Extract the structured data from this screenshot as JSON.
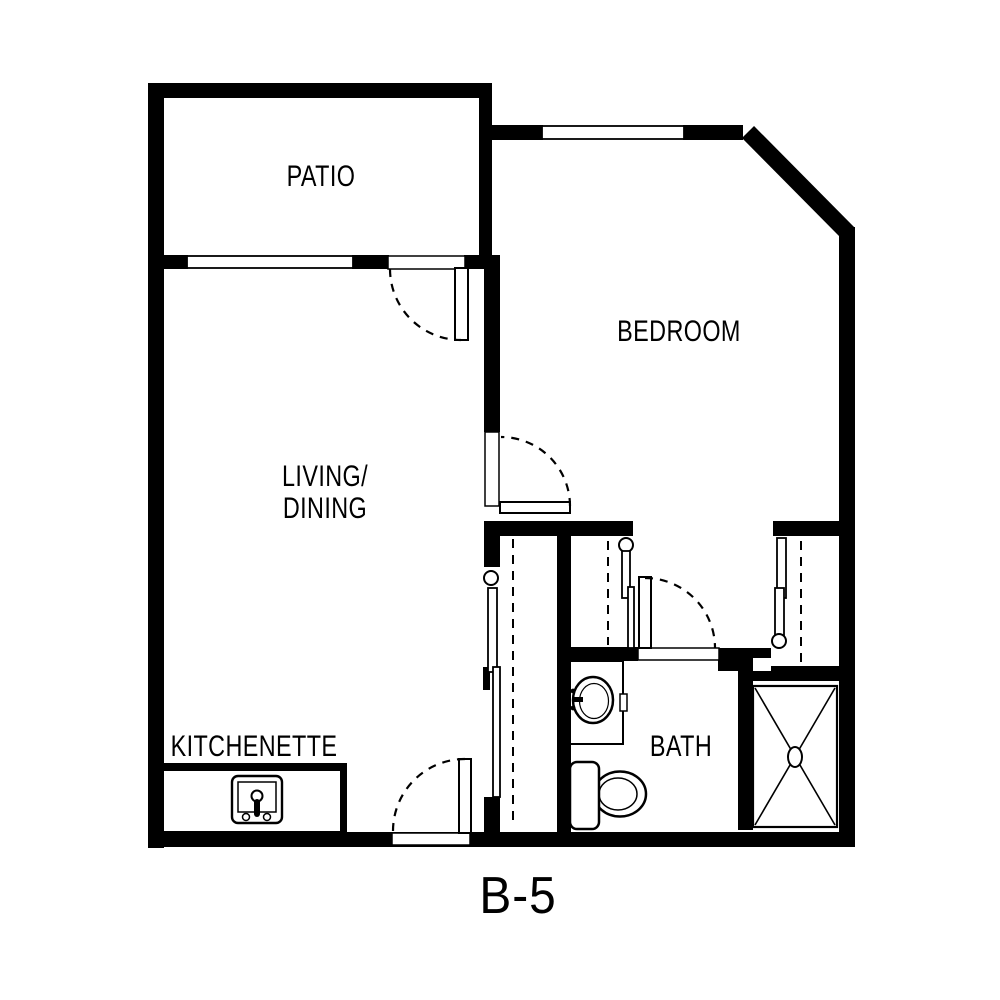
{
  "plan": {
    "title": "B-5",
    "rooms": [
      {
        "id": "patio",
        "label": "PATIO"
      },
      {
        "id": "bedroom",
        "label": "BEDROOM"
      },
      {
        "id": "living-dining",
        "lines": [
          "LIVING/",
          "DINING"
        ]
      },
      {
        "id": "kitchenette",
        "label": "KITCHENETTE"
      },
      {
        "id": "bath",
        "label": "BATH"
      }
    ],
    "doors": [
      "patio-door",
      "bedroom-door",
      "bath-door",
      "entry-door"
    ],
    "windows": [
      "patio-window",
      "bedroom-window"
    ],
    "closets": [
      "hall-closet-left",
      "hall-closet-right",
      "living-room-closet"
    ],
    "fixtures": [
      "kitchen-sink",
      "vanity-sink",
      "toilet",
      "shower"
    ],
    "colors": {
      "line": "#000000",
      "background": "#ffffff"
    }
  }
}
